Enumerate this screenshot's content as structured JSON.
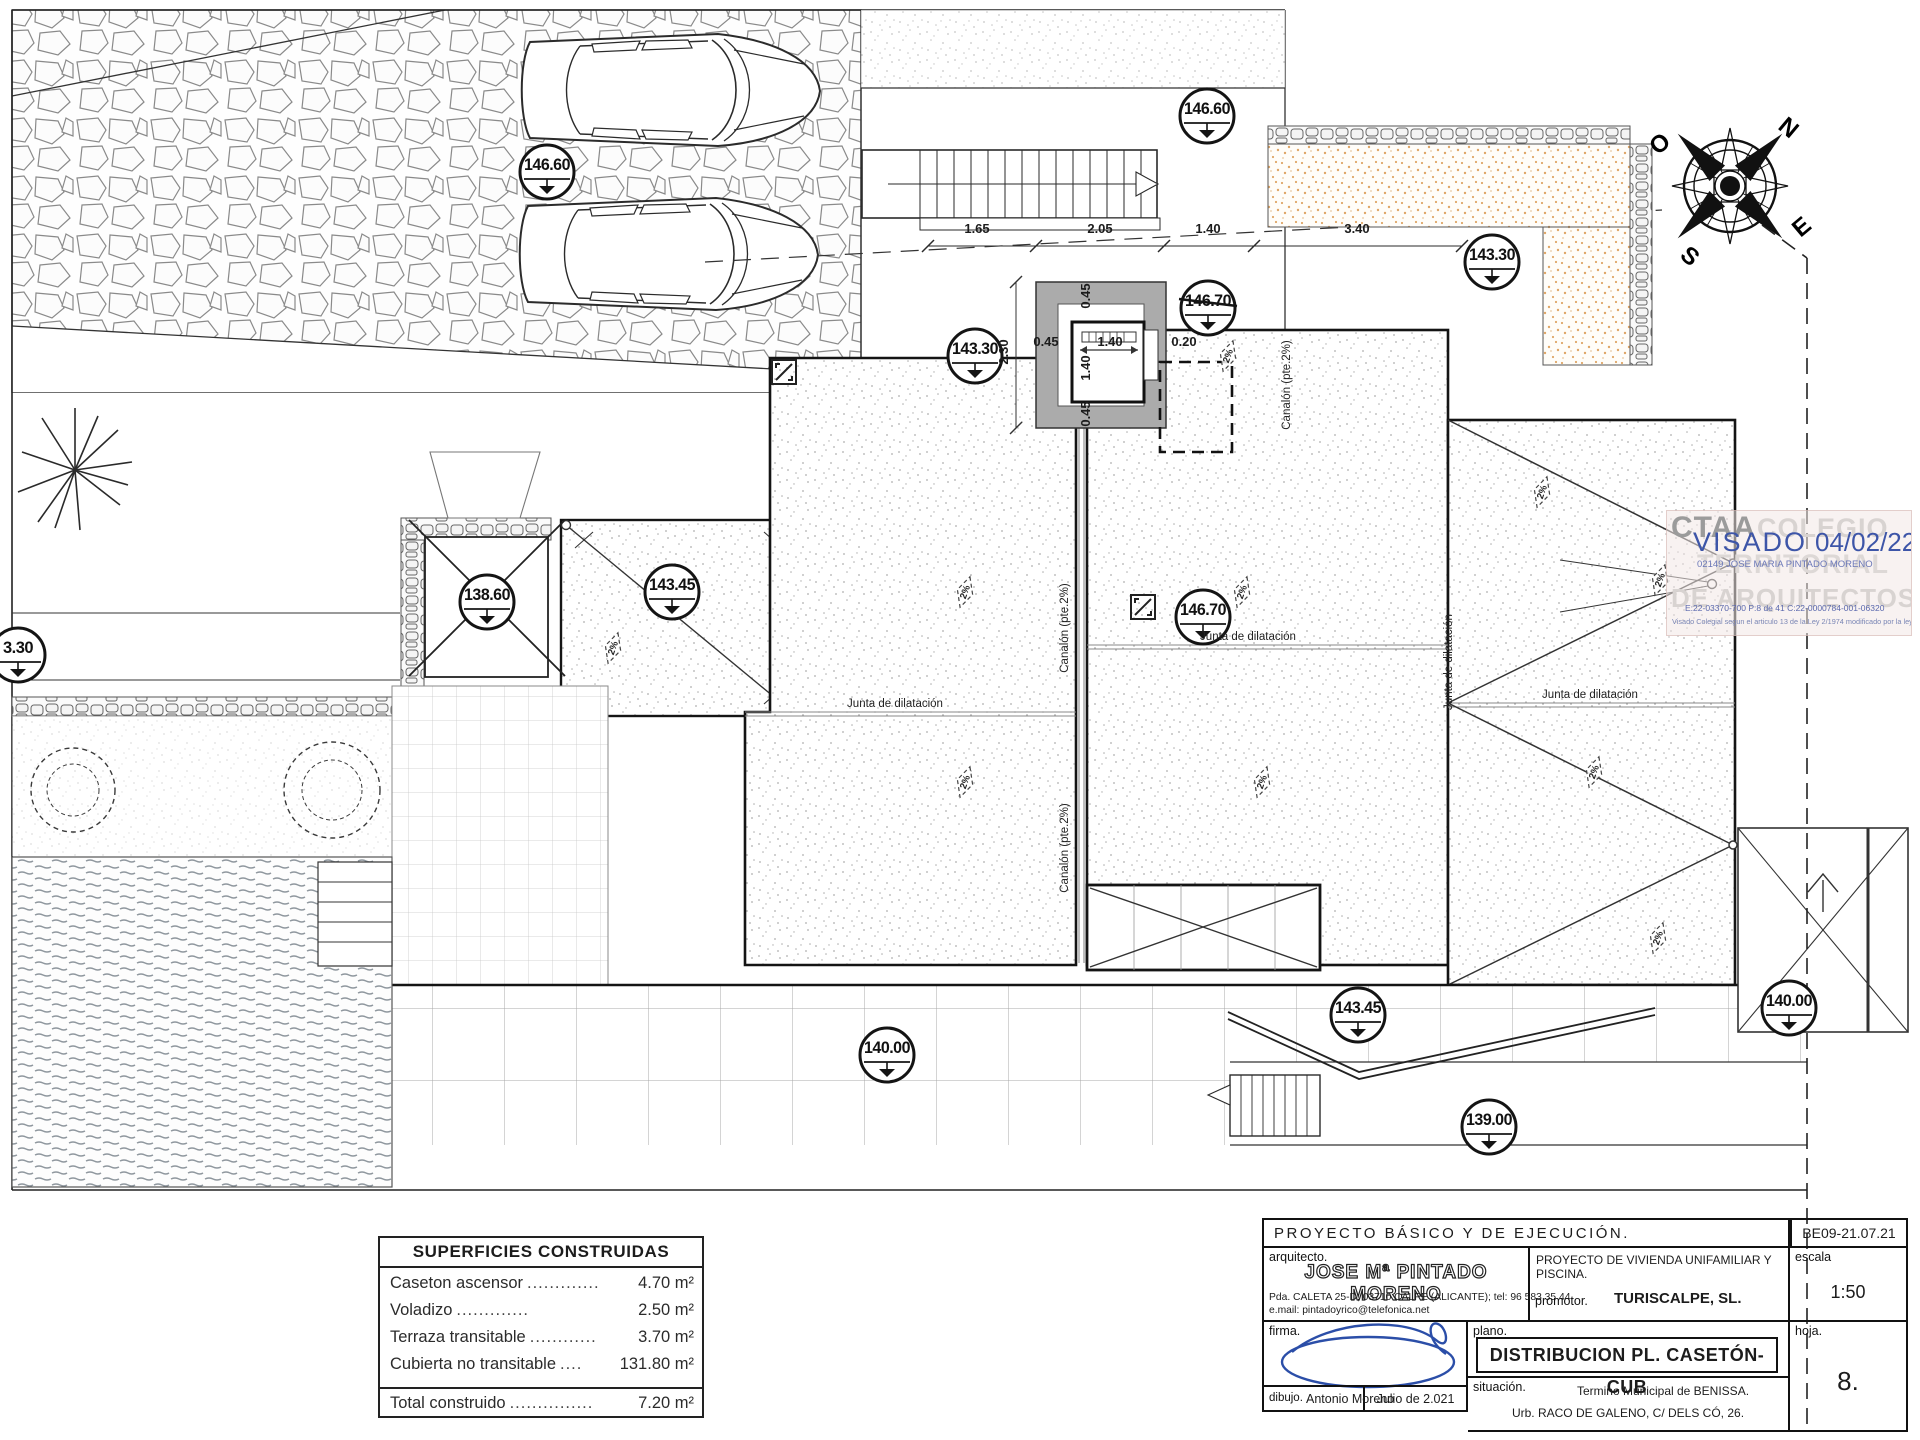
{
  "drawing": {
    "markers": [
      {
        "value": "146.60",
        "x": 547,
        "y": 172
      },
      {
        "value": "146.60",
        "x": 1207,
        "y": 116
      },
      {
        "value": "143.30",
        "x": 975,
        "y": 356
      },
      {
        "value": "146.70",
        "x": 1208,
        "y": 308,
        "struck": true
      },
      {
        "value": "143.30",
        "x": 1492,
        "y": 262
      },
      {
        "value": "3.30",
        "x": 18,
        "y": 655
      },
      {
        "value": "138.60",
        "x": 487,
        "y": 602,
        "crossed": true
      },
      {
        "value": "143.45",
        "x": 672,
        "y": 592
      },
      {
        "value": "146.70",
        "x": 1203,
        "y": 617
      },
      {
        "value": "140.00",
        "x": 887,
        "y": 1055
      },
      {
        "value": "143.45",
        "x": 1358,
        "y": 1015
      },
      {
        "value": "139.00",
        "x": 1489,
        "y": 1127
      },
      {
        "value": "140.00",
        "x": 1789,
        "y": 1008
      }
    ],
    "dimensions": [
      {
        "t": "1.65",
        "x": 977,
        "y": 233
      },
      {
        "t": "2.05",
        "x": 1100,
        "y": 233
      },
      {
        "t": "1.40",
        "x": 1208,
        "y": 233
      },
      {
        "t": "3.40",
        "x": 1357,
        "y": 233
      },
      {
        "t": "2.30",
        "x": 1008,
        "y": 352,
        "rot": -90
      },
      {
        "t": "0.45",
        "x": 1090,
        "y": 296,
        "rot": -90
      },
      {
        "t": "0.45",
        "x": 1046,
        "y": 346
      },
      {
        "t": "1.40",
        "x": 1110,
        "y": 346
      },
      {
        "t": "0.20",
        "x": 1184,
        "y": 346
      },
      {
        "t": "1.40",
        "x": 1090,
        "y": 368,
        "rot": -90
      },
      {
        "t": "0.45",
        "x": 1090,
        "y": 414,
        "rot": -90
      }
    ],
    "labels": [
      {
        "t": "Junta de dilatación",
        "x": 895,
        "y": 707
      },
      {
        "t": "Junta de dilatación",
        "x": 1248,
        "y": 640
      },
      {
        "t": "Junta de dilatación",
        "x": 1590,
        "y": 698
      },
      {
        "t": "Junta de dilatación",
        "x": 1452,
        "y": 662,
        "rot": -90
      },
      {
        "t": "Canalón (pte.2%)",
        "x": 1068,
        "y": 628,
        "rot": -90
      },
      {
        "t": "Canalón (pte.2%)",
        "x": 1068,
        "y": 848,
        "rot": -90
      },
      {
        "t": "Canalón (pte.2%)",
        "x": 1290,
        "y": 385,
        "rot": -90
      }
    ],
    "slope_text": "2%",
    "slopes": [
      [
        965,
        592
      ],
      [
        1242,
        592
      ],
      [
        965,
        782
      ],
      [
        1262,
        782
      ],
      [
        1228,
        356
      ],
      [
        1542,
        492
      ],
      [
        1660,
        580
      ],
      [
        1594,
        772
      ],
      [
        1658,
        938
      ],
      [
        613,
        648
      ]
    ]
  },
  "compass": {
    "n": "N",
    "e": "E",
    "s": "S",
    "o": "O"
  },
  "areas_table": {
    "title": "SUPERFICIES CONSTRUIDAS",
    "rows": [
      {
        "label": "Caseton ascensor",
        "dots": ".............",
        "value": "4.70 m²"
      },
      {
        "label": "Voladizo",
        "dots": ".............",
        "value": "2.50 m²"
      },
      {
        "label": "Terraza transitable",
        "dots": "............",
        "value": "3.70 m²"
      },
      {
        "label": "Cubierta no transitable",
        "dots": "....",
        "value": "131.80 m²"
      }
    ],
    "total": {
      "label": "Total construido",
      "dots": "...............",
      "value": "7.20 m²"
    }
  },
  "title_block": {
    "project_header": "PROYECTO BÁSICO Y DE EJECUCIÓN.",
    "ref": "BE09-21.07.21",
    "arquitecto_label": "arquitecto.",
    "arquitecto_name": "JOSE Mª PINTADO MORENO",
    "arquitecto_address": "Pda. CALETA 25-D; 03710 CALPE (ALICANTE); tel: 96 583 35 44.",
    "arquitecto_email": "e.mail: pintadoyrico@telefonica.net",
    "proyecto": "PROYECTO DE VIVIENDA UNIFAMILIAR Y PISCINA.",
    "promotor_label": "promotor.",
    "promotor": "TURISCALPE, SL.",
    "escala_label": "escala",
    "escala": "1:50",
    "firma_label": "firma.",
    "plano_label": "plano.",
    "plano": "DISTRIBUCION PL. CASETÓN-CUB",
    "situacion_label": "situación.",
    "situacion1": "Termino Municipal de BENISSA.",
    "situacion2": "Urb. RACO DE GALENO, C/ DELS CÓ, 26.",
    "hoja_label": "hoja.",
    "hoja": "8.",
    "dibujo_label": "dibujo.",
    "dibujo": "Antonio Moreno",
    "fecha": "Julio de 2.021"
  },
  "stamp": {
    "org_abbr": "CTAA",
    "wm1": "COLEGIO",
    "wm2": "TERRITORIAL",
    "wm3": "DE ARQUITECTOS",
    "visado": "VISADO",
    "visado_date": "04/02/22",
    "arch_line": "02149 JOSE MARIA PINTADO MORENO",
    "codes": "E:22-03370-700    P:8 de 41    C:22-0000784-001-06320",
    "legal": "Visado Colegial segun el articulo 13 de la Ley 2/1974 modificado por la ley 25/2009",
    "blue": "#3d55a8"
  }
}
